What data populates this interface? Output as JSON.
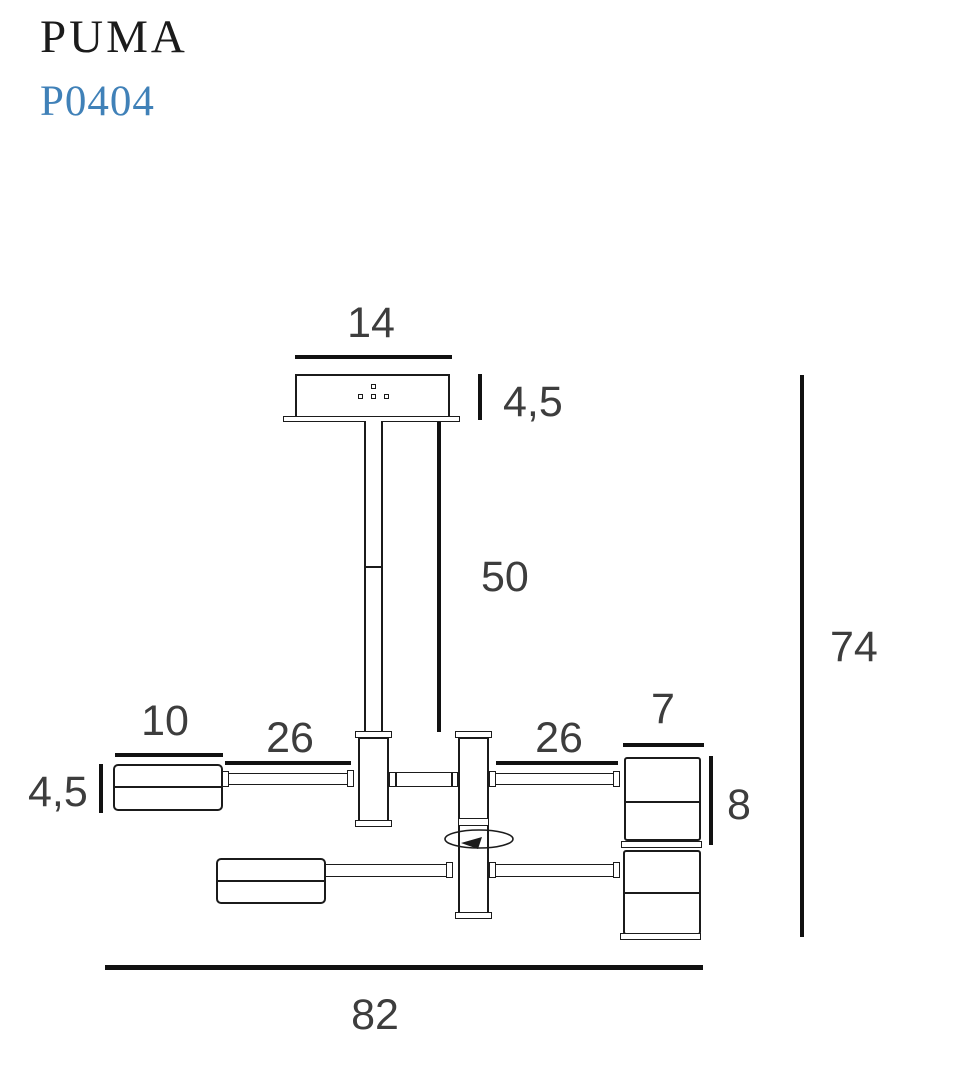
{
  "header": {
    "product_name": "PUMA",
    "product_code": "P0404"
  },
  "diagram": {
    "type": "technical-dimension-drawing",
    "dimensions": {
      "canopy_width": "14",
      "canopy_height": "4,5",
      "rod_length": "50",
      "overall_height": "74",
      "left_head_length": "10",
      "left_head_height": "4,5",
      "left_arm_length": "26",
      "right_arm_length": "26",
      "right_head_width": "7",
      "right_head_height": "8",
      "overall_width": "82"
    },
    "icons": {
      "rotation_arrow": "rotation-arrow"
    }
  },
  "colors": {
    "line": "#1b1b1b",
    "dimension_line": "#111111",
    "dimension_text": "#3d3d3d",
    "product_code_blue": "#4081b8",
    "background": "#ffffff"
  }
}
